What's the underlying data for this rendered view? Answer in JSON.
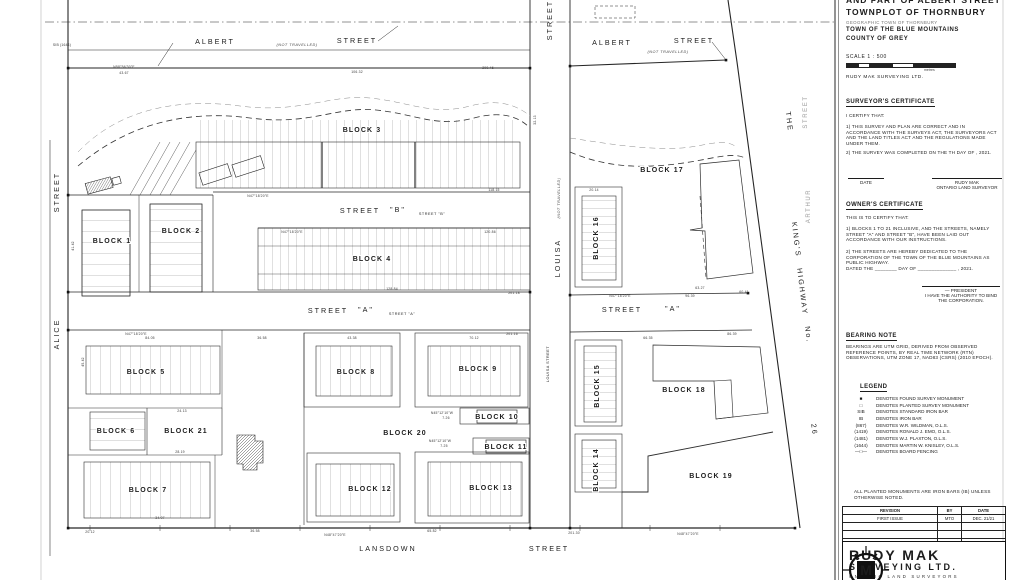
{
  "title_block": {
    "supertitle": "AND PART OF ALBERT STREET",
    "title": "TOWNPLOT OF THORNBURY",
    "subtitle": "GEOGRAPHIC TOWN OF THORNBURY",
    "municipality": "TOWN OF THE BLUE MOUNTAINS",
    "county": "COUNTY OF GREY",
    "scale": "SCALE  1 : 500",
    "scale_units": "metres",
    "firm": "RUDY MAK SURVEYING LTD."
  },
  "surveyors_certificate": {
    "heading": "SURVEYOR'S CERTIFICATE",
    "intro": "I CERTIFY THAT:",
    "clause1": "1)  THIS SURVEY AND PLAN ARE CORRECT AND IN ACCORDANCE WITH THE SURVEYS ACT, THE SURVEYORS ACT AND THE LAND TITLES ACT AND THE REGULATIONS MADE UNDER THEM.",
    "clause2": "2)  THE SURVEY WAS COMPLETED ON THE       TH DAY OF                  , 2021.",
    "date_label": "DATE",
    "signer": "RUDY MAK",
    "signer_title": "ONTARIO LAND SURVEYOR"
  },
  "owners_certificate": {
    "heading": "OWNER'S CERTIFICATE",
    "intro": "THIS IS TO CERTIFY THAT:",
    "clause1": "1)  BLOCKS 1 TO 21 INCLUSIVE, AND THE STREETS, NAMELY STREET \"A\" AND STREET \"B\", HAVE BEEN LAID OUT ACCORDANCE WITH OUR INSTRUCTIONS.",
    "clause2": "2)  THE STREETS ARE HEREBY DEDICATED TO THE CORPORATION OF THE TOWN OF THE BLUE MOUNTAINS AS PUBLIC HIGHWAY.",
    "dated": "DATED THE  ________  DAY OF  ______________ , 2021.",
    "president": "— PRESIDENT",
    "authority": "I HAVE THE AUTHORITY TO BIND THE CORPORATION."
  },
  "bearing_note": {
    "heading": "BEARING NOTE",
    "text": "BEARINGS ARE UTM GRID, DERIVED FROM OBSERVED REFERENCE POINTS, BY REAL TIME NETWORK (RTN) OBSERVATIONS, UTM ZONE 17, NAD83 (CSRS) (2010 EPOCH)."
  },
  "legend": {
    "heading": "LEGEND",
    "items": [
      {
        "symbol": "■",
        "text": "DENOTES  FOUND SURVEY MONUMENT"
      },
      {
        "symbol": "□",
        "text": "DENOTES  PLANTED SURVEY MONUMENT"
      },
      {
        "symbol": "SIB",
        "text": "DENOTES  STANDARD IRON BAR"
      },
      {
        "symbol": "IB",
        "text": "DENOTES  IRON BAR"
      },
      {
        "symbol": "(867)",
        "text": "DENOTES  W.R. WILDMAN, O.L.S."
      },
      {
        "symbol": "(1419)",
        "text": "DENOTES  RONALD J. EMO, O.L.S."
      },
      {
        "symbol": "(1481)",
        "text": "DENOTES  W.J. PLAXTON, O.L.S."
      },
      {
        "symbol": "(1644)",
        "text": "DENOTES  MARTIN W. KNISLEY, O.L.S."
      },
      {
        "symbol": "—□—",
        "text": "DENOTES  BOARD FENCING"
      }
    ]
  },
  "notes": {
    "monument_note": "ALL PLANTED MONUMENTS ARE IRON BARS (IB) UNLESS OTHERWISE NOTED."
  },
  "revision_table": {
    "headers": [
      "REVISION",
      "BY",
      "DATE"
    ],
    "rows": [
      [
        "FIRST ISSUE",
        "MTO",
        "DEC. 21/21"
      ],
      [
        "",
        "",
        ""
      ],
      [
        "",
        "",
        ""
      ],
      [
        "",
        "",
        ""
      ]
    ]
  },
  "logo": {
    "monogram": "M",
    "name_line1": "RUDY MAK",
    "name_line2": "SURVEYING LTD.",
    "name_line3": "ONTARIO LAND SURVEYORS"
  },
  "map": {
    "street_labels": [
      {
        "t": "ALBERT",
        "x": 215,
        "y": 44
      },
      {
        "t": "(NOT TRAVELLED)",
        "x": 297,
        "y": 46,
        "cls": "smi"
      },
      {
        "t": "STREET",
        "x": 357,
        "y": 43
      },
      {
        "t": "ALBERT",
        "x": 612,
        "y": 45
      },
      {
        "t": "(NOT TRAVELLED)",
        "x": 668,
        "y": 53,
        "cls": "smi"
      },
      {
        "t": "STREET",
        "x": 694,
        "y": 43
      },
      {
        "t": "STREET",
        "x": 552,
        "y": 20,
        "r": -90
      },
      {
        "t": "(NOT TRAVELLED)",
        "x": 560,
        "y": 198,
        "r": -90,
        "cls": "smi"
      },
      {
        "t": "LOUISA",
        "x": 560,
        "y": 258,
        "r": -90
      },
      {
        "t": "LOUISA STREET",
        "x": 549,
        "y": 364,
        "r": -90,
        "cls": "sm"
      },
      {
        "t": "STREET",
        "x": 59,
        "y": 192,
        "r": -90
      },
      {
        "t": "ALICE",
        "x": 59,
        "y": 334,
        "r": -90
      },
      {
        "t": "STREET",
        "x": 360,
        "y": 213
      },
      {
        "t": "\"B\"",
        "x": 398,
        "y": 212
      },
      {
        "t": "STREET \"B\"",
        "x": 432,
        "y": 215,
        "cls": "sm"
      },
      {
        "t": "STREET",
        "x": 328,
        "y": 313
      },
      {
        "t": "\"A\"",
        "x": 366,
        "y": 312
      },
      {
        "t": "STREET \"A\"",
        "x": 402,
        "y": 315,
        "cls": "sm"
      },
      {
        "t": "STREET",
        "x": 622,
        "y": 312
      },
      {
        "t": "\"A\"",
        "x": 673,
        "y": 311
      },
      {
        "t": "LANSDOWN",
        "x": 388,
        "y": 551
      },
      {
        "t": "STREET",
        "x": 549,
        "y": 551
      },
      {
        "t": "THE",
        "x": 787,
        "y": 122,
        "r": 83
      },
      {
        "t": "KING'S",
        "x": 794,
        "y": 240,
        "r": 83
      },
      {
        "t": "HIGHWAY",
        "x": 800,
        "y": 292,
        "r": 83
      },
      {
        "t": "No.",
        "x": 806,
        "y": 335,
        "r": 83
      },
      {
        "t": "26",
        "x": 812,
        "y": 430,
        "r": 83
      },
      {
        "t": "ARTHUR",
        "x": 810,
        "y": 206,
        "r": -90,
        "cls": "ghost"
      },
      {
        "t": "STREET",
        "x": 807,
        "y": 112,
        "r": -90,
        "cls": "ghost"
      }
    ],
    "block_labels": [
      {
        "t": "BLOCK 1",
        "x": 112,
        "y": 243
      },
      {
        "t": "BLOCK 2",
        "x": 181,
        "y": 233
      },
      {
        "t": "BLOCK 3",
        "x": 362,
        "y": 132
      },
      {
        "t": "BLOCK 4",
        "x": 372,
        "y": 261
      },
      {
        "t": "BLOCK 5",
        "x": 146,
        "y": 374
      },
      {
        "t": "BLOCK 6",
        "x": 116,
        "y": 433
      },
      {
        "t": "BLOCK 7",
        "x": 148,
        "y": 492
      },
      {
        "t": "BLOCK 8",
        "x": 356,
        "y": 374
      },
      {
        "t": "BLOCK 9",
        "x": 478,
        "y": 371
      },
      {
        "t": "BLOCK 10",
        "x": 497,
        "y": 419
      },
      {
        "t": "BLOCK 11",
        "x": 506,
        "y": 449
      },
      {
        "t": "BLOCK 12",
        "x": 370,
        "y": 491
      },
      {
        "t": "BLOCK 13",
        "x": 491,
        "y": 490
      },
      {
        "t": "BLOCK 14",
        "x": 598,
        "y": 470,
        "r": -90
      },
      {
        "t": "BLOCK 15",
        "x": 599,
        "y": 386,
        "r": -90
      },
      {
        "t": "BLOCK 16",
        "x": 598,
        "y": 238,
        "r": -90
      },
      {
        "t": "BLOCK 17",
        "x": 662,
        "y": 172
      },
      {
        "t": "BLOCK 18",
        "x": 684,
        "y": 392
      },
      {
        "t": "BLOCK 19",
        "x": 711,
        "y": 478
      },
      {
        "t": "BLOCK 20",
        "x": 405,
        "y": 435
      },
      {
        "t": "BLOCK 21",
        "x": 186,
        "y": 433
      }
    ],
    "dimensions": [
      {
        "t": "N58°56'30\"E",
        "x": 124,
        "y": 68
      },
      {
        "t": "43.67",
        "x": 124,
        "y": 74
      },
      {
        "t": "106.32",
        "x": 357,
        "y": 73
      },
      {
        "t": "200.46",
        "x": 488,
        "y": 69
      },
      {
        "t": "N47°18'20\"E",
        "x": 258,
        "y": 197
      },
      {
        "t": "118.15",
        "x": 494,
        "y": 191
      },
      {
        "t": "N47°18'20\"E",
        "x": 292,
        "y": 233
      },
      {
        "t": "120.86",
        "x": 490,
        "y": 233
      },
      {
        "t": "128.84",
        "x": 392,
        "y": 290
      },
      {
        "t": "201.18",
        "x": 514,
        "y": 294
      },
      {
        "t": "N47°18'20\"E",
        "x": 136,
        "y": 335
      },
      {
        "t": "84.05",
        "x": 150,
        "y": 339
      },
      {
        "t": "36.58",
        "x": 262,
        "y": 339
      },
      {
        "t": "43.38",
        "x": 352,
        "y": 339
      },
      {
        "t": "70.12",
        "x": 474,
        "y": 339
      },
      {
        "t": "201.16",
        "x": 512,
        "y": 335
      },
      {
        "t": "24.13",
        "x": 182,
        "y": 412
      },
      {
        "t": "28.19",
        "x": 180,
        "y": 453
      },
      {
        "t": "N45°12'10\"W",
        "x": 442,
        "y": 414
      },
      {
        "t": "7.26",
        "x": 446,
        "y": 419
      },
      {
        "t": "N45°12'10\"W",
        "x": 440,
        "y": 442
      },
      {
        "t": "7.25",
        "x": 444,
        "y": 447
      },
      {
        "t": "34.07",
        "x": 160,
        "y": 519
      },
      {
        "t": "20.12",
        "x": 90,
        "y": 533
      },
      {
        "t": "36.58",
        "x": 255,
        "y": 532
      },
      {
        "t": "65.82",
        "x": 432,
        "y": 532
      },
      {
        "t": "N48°47'20\"E",
        "x": 335,
        "y": 536
      },
      {
        "t": "201.30",
        "x": 574,
        "y": 534
      },
      {
        "t": "N48°47'20\"E",
        "x": 688,
        "y": 535
      },
      {
        "t": "20.14",
        "x": 594,
        "y": 191
      },
      {
        "t": "63.27",
        "x": 700,
        "y": 289
      },
      {
        "t": "60.41",
        "x": 744,
        "y": 293
      },
      {
        "t": "86.39",
        "x": 732,
        "y": 335
      },
      {
        "t": "66.35",
        "x": 648,
        "y": 339
      },
      {
        "t": "N47°18'20\"E",
        "x": 620,
        "y": 297
      },
      {
        "t": "96.39",
        "x": 690,
        "y": 297
      },
      {
        "t": "45.42",
        "x": 84,
        "y": 362,
        "r": -90
      },
      {
        "t": "41.42",
        "x": 74,
        "y": 246,
        "r": -90
      },
      {
        "t": "32.13",
        "x": 536,
        "y": 120,
        "r": -90
      },
      {
        "t": "SIB (1644)",
        "x": 62,
        "y": 46
      }
    ]
  }
}
